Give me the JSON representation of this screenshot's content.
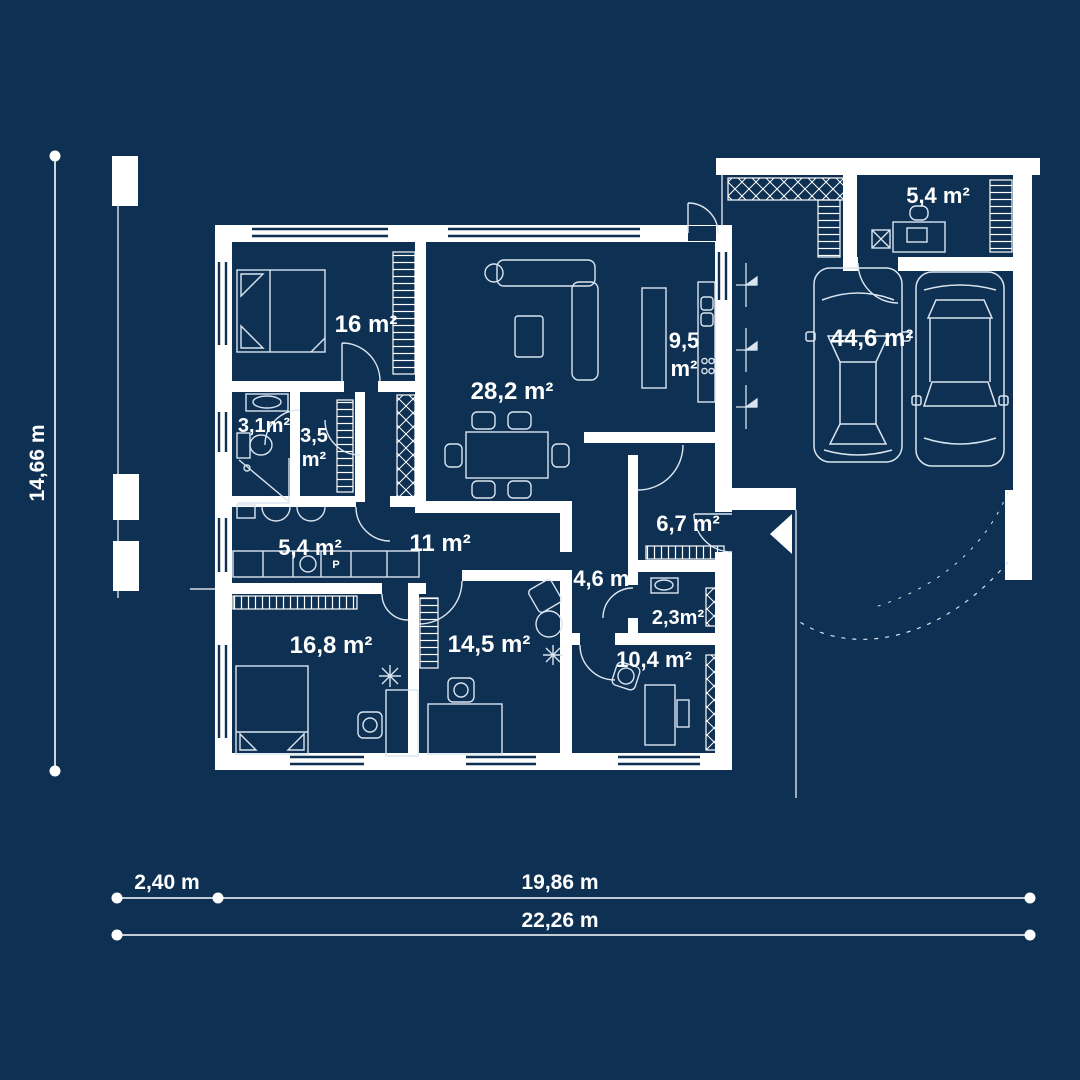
{
  "title": "House floor plan blueprint",
  "colors": {
    "background": "#0e3052",
    "walls": "#ffffff",
    "furniture_line": "#d9e4f0",
    "text": "#ffffff"
  },
  "rooms": {
    "bedroom1": "16 m²",
    "living": "28,2 m²",
    "kitchen_line1": "9,5",
    "kitchen_line2": "m²",
    "garage_storage": "5,4 m²",
    "garage": "44,6 m²",
    "bathroom": "3,1m²",
    "closet_line1": "3,5",
    "closet_line2": "m²",
    "utility": "5,4 m²",
    "hallway": "11 m²",
    "entry": "6,7 m²",
    "corridor": "4,6 m²",
    "wc": "2,3m²",
    "bedroom2": "16,8 m²",
    "bedroom3": "14,5 m²",
    "office": "10,4 m²"
  },
  "markings": {
    "washing_machine": "P"
  },
  "dimensions": {
    "total_height": "14,66 m",
    "left_width": "2,40 m",
    "right_width": "19,86 m",
    "total_width": "22,26 m"
  }
}
